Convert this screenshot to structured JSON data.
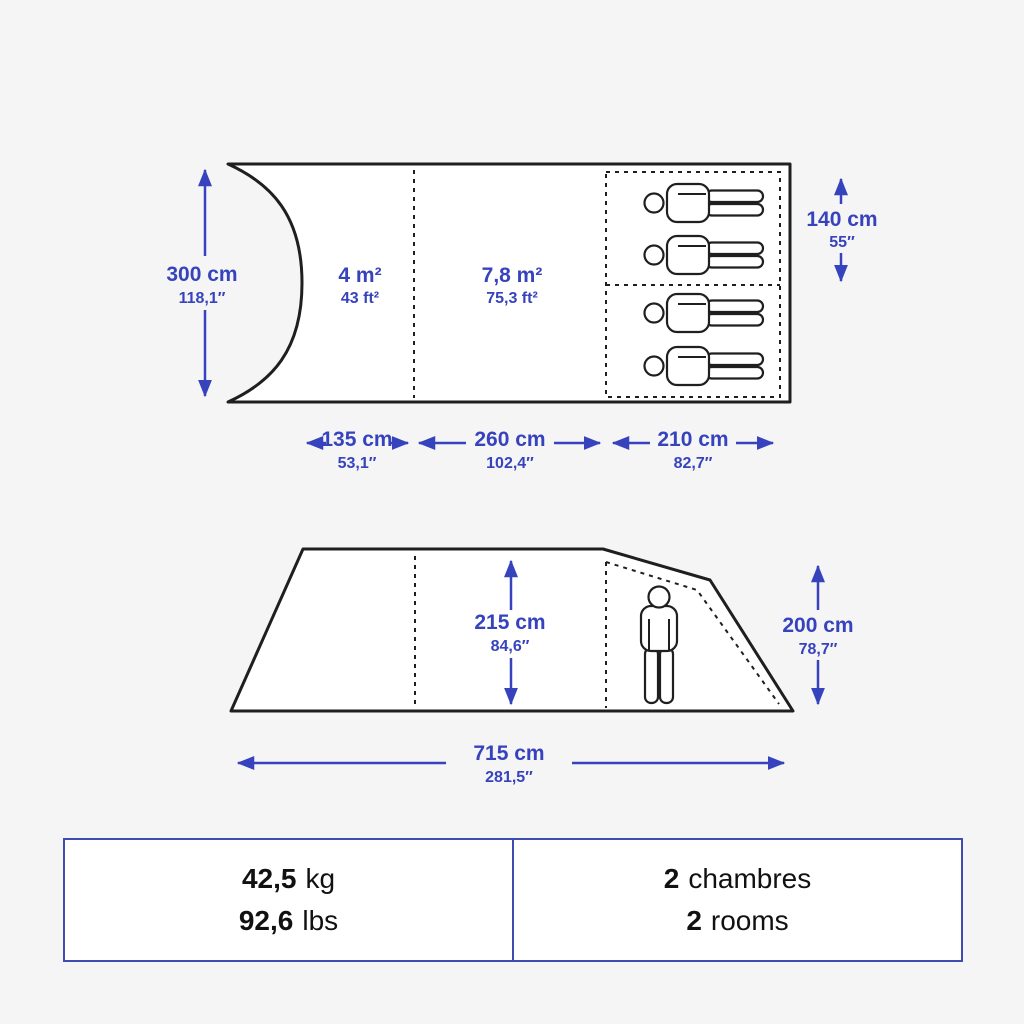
{
  "colors": {
    "accent": "#3643bc",
    "line": "#1f1f1f",
    "bg": "#f5f5f6",
    "ink": "#111111",
    "table_border": "#3f4cb0"
  },
  "top_view": {
    "height": {
      "cm": "300 cm",
      "in": "118,1″"
    },
    "porch_area": {
      "m2": "4 m²",
      "ft2": "43 ft²"
    },
    "living_area": {
      "m2": "7,8 m²",
      "ft2": "75,3 ft²"
    },
    "bedroom_width": {
      "cm": "140 cm",
      "in": "55″"
    },
    "porch_length": {
      "cm": "135 cm",
      "in": "53,1″"
    },
    "living_length": {
      "cm": "260 cm",
      "in": "102,4″"
    },
    "bedroom_length": {
      "cm": "210 cm",
      "in": "82,7″"
    }
  },
  "side_view": {
    "interior_height": {
      "cm": "215 cm",
      "in": "84,6″"
    },
    "rear_height": {
      "cm": "200 cm",
      "in": "78,7″"
    },
    "total_length": {
      "cm": "715 cm",
      "in": "281,5″"
    }
  },
  "specs_table": {
    "weight": {
      "kg_value": "42,5",
      "kg_unit": "kg",
      "lbs_value": "92,6",
      "lbs_unit": "lbs"
    },
    "rooms": {
      "count_fr": "2",
      "label_fr": "chambres",
      "count_en": "2",
      "label_en": "rooms"
    }
  }
}
